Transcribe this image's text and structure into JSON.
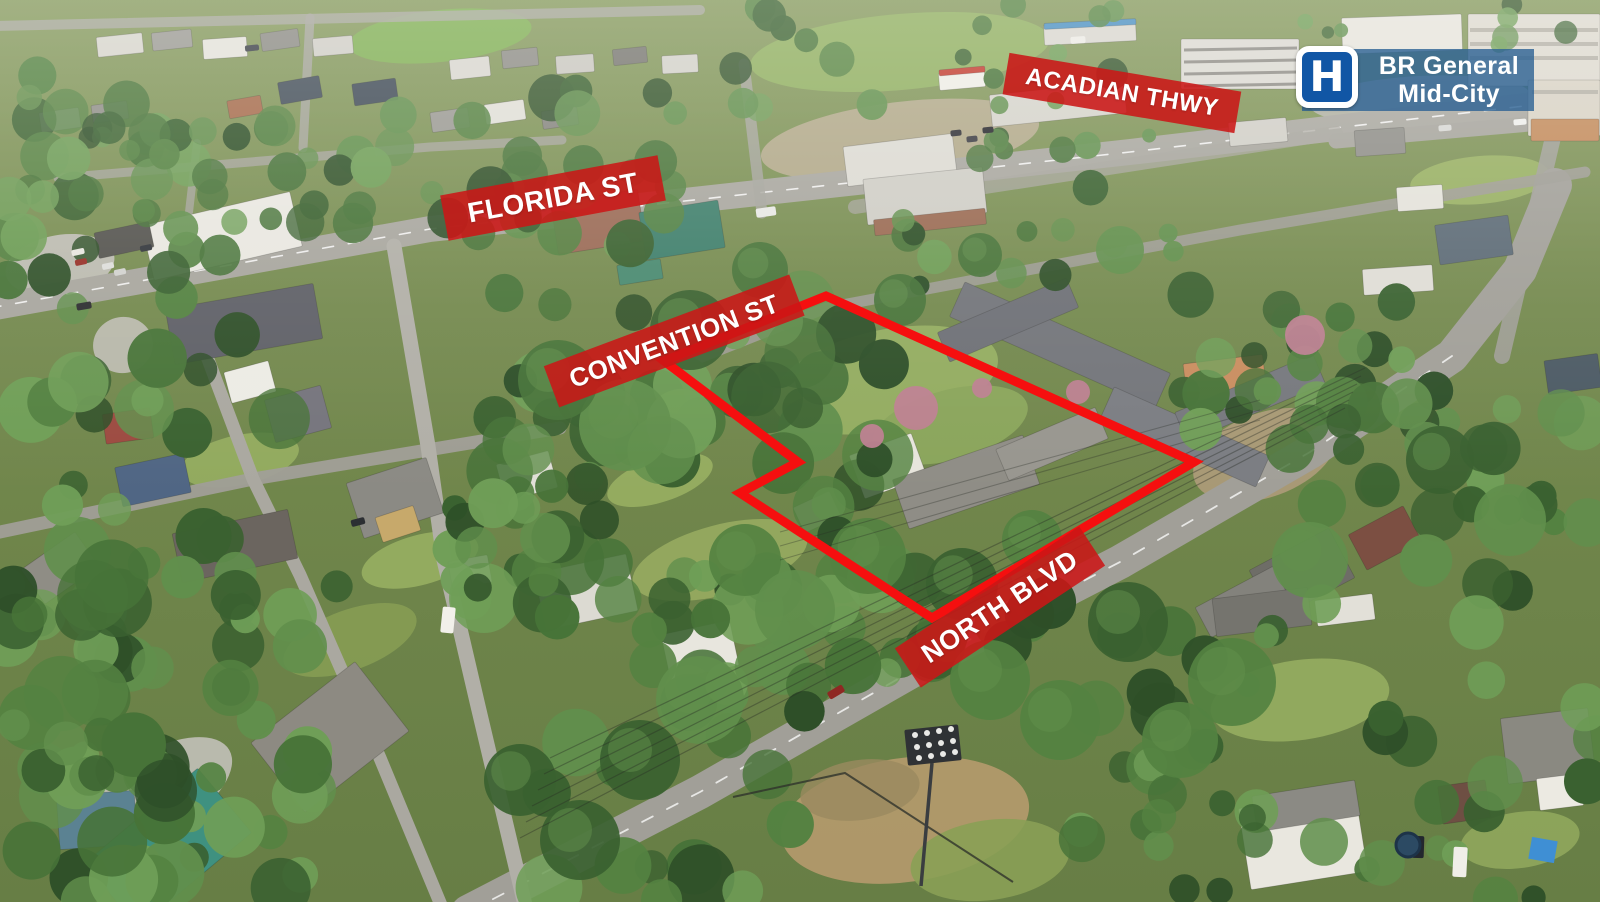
{
  "annotations": {
    "street_labels": {
      "florida": {
        "text": "FLORIDA ST"
      },
      "acadian": {
        "text": "ACADIAN THWY"
      },
      "convention": {
        "text": "CONVENTION ST"
      },
      "north_blvd": {
        "text": "NORTH BLVD"
      }
    },
    "hospital_badge": {
      "icon": "hospital-h-icon",
      "icon_letter": "H",
      "line1": "BR General",
      "line2": "Mid-City"
    },
    "property_boundary": {
      "shape": "polygon",
      "color": "#f50f0f",
      "stroke_width": 9,
      "points": [
        [
          826,
          296
        ],
        [
          1194,
          462
        ],
        [
          932,
          618
        ],
        [
          740,
          493
        ],
        [
          798,
          462
        ],
        [
          664,
          361
        ]
      ]
    }
  },
  "colors": {
    "banner_red": "rgba(203,23,23,0.88)",
    "badge_blue": "rgba(44,98,148,0.8)",
    "hospital_sign_blue": "#1156a5",
    "boundary_red": "#f50f0f",
    "label_text": "#ffffff"
  }
}
